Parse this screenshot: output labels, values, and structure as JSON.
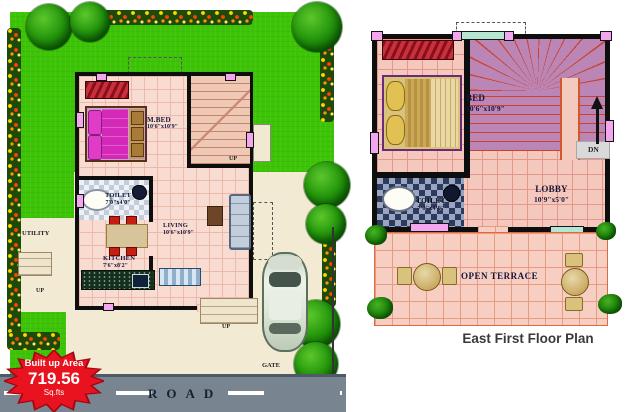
{
  "caption": "East First Floor Plan",
  "road": {
    "label": "ROAD"
  },
  "badge": {
    "title": "Built up Area",
    "value": "719.56",
    "unit": "Sq.fts"
  },
  "ground_floor": {
    "mbed": {
      "name": "M.BED",
      "dim": "10'6\"x10'9\""
    },
    "toilet": {
      "name": "TOILET",
      "dim": "7'0\"x4'0\""
    },
    "kitchen": {
      "name": "KITCHEN",
      "dim": "7'6\"x8'2\""
    },
    "living": {
      "name": "LIVING",
      "dim": "10'6\"x10'9\""
    },
    "utility_label": "UTILITY",
    "stairs_up_label": "UP",
    "porch_up_label": "UP",
    "side_up_label": "UP",
    "gate_label": "GATE"
  },
  "first_floor": {
    "bed": {
      "name": "BED",
      "dim": "10'6\"x10'9\""
    },
    "toilet": {
      "name": "TOILET",
      "dim": "7'0\"x4'0\""
    },
    "lobby": {
      "name": "LOBBY",
      "dim": "10'9\"x5'0\""
    },
    "terrace_label": "OPEN TERRACE",
    "dn_label": "DN"
  },
  "colors": {
    "lawn_green": "#3ec407",
    "floor_pink": "#f8dcd2",
    "terrace_pink": "#f7cec2",
    "stair_mauve": "#bb85b5",
    "wall_black": "#0e0e0e",
    "window_pink": "#f2a6ee",
    "badge_red": "#e8131f",
    "road_gray": "#78848f",
    "label_ink": "#16163a"
  }
}
